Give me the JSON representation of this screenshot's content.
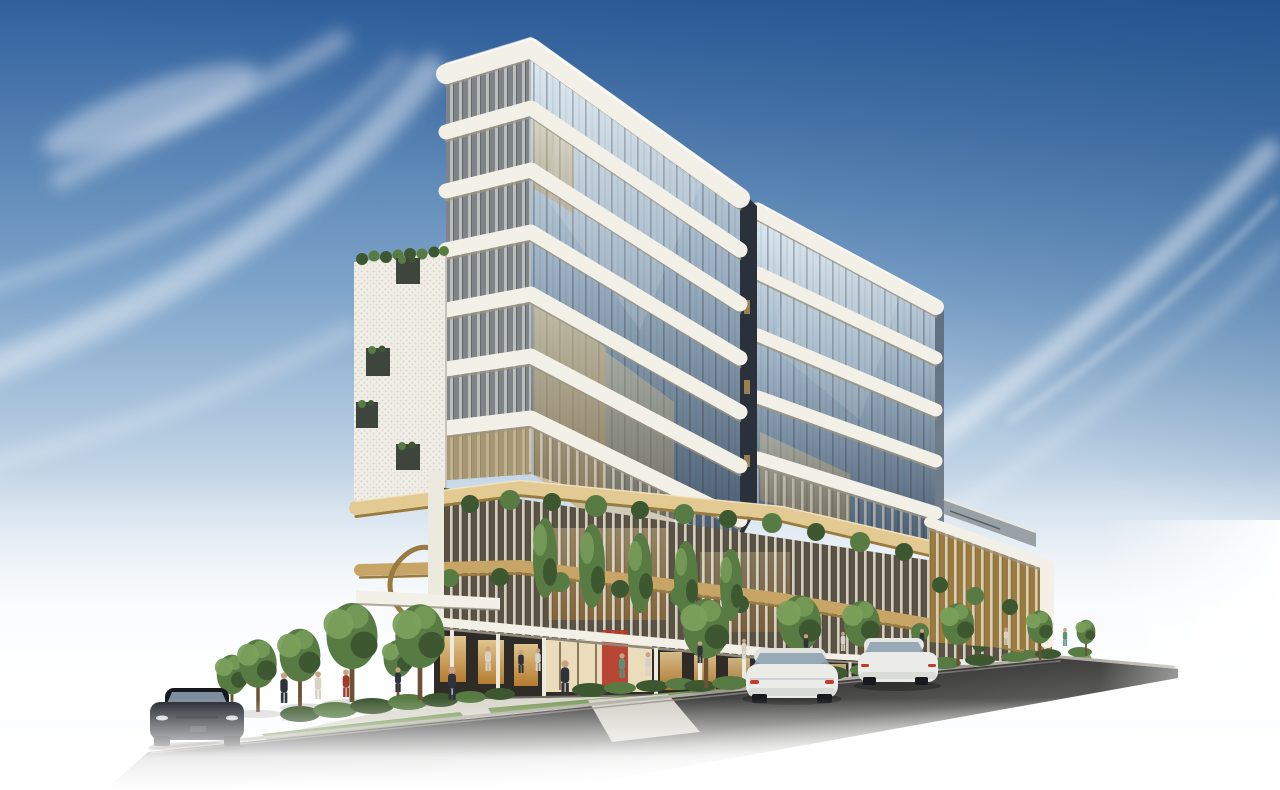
{
  "scene": {
    "type": "architectural-rendering",
    "description": "Daytime photorealistic render of a modern curved mixed-use tower: stacked white rounded floor slabs over glass, a white perforated-screen wing on the left, a golden podium with vertical fins and hanging greenery, ground-floor retail with warm lighting, street trees, pedestrians and three parked cars on a road that fades to white at the image edges under a blue sky with wispy cirrus clouds.",
    "time_of_day": "day",
    "sky": {
      "condition": "clear blue with wispy cirrus cloud streaks",
      "deepest_corner": "top-right",
      "horizon": "fades to white"
    },
    "building": {
      "tower_glass_floors": 7,
      "right_section_floors": 5,
      "podium_levels": 2,
      "features": [
        "rounded white slab bands",
        "glass curtain wall",
        "perforated white screen wing",
        "gold vertical fins with climbing plants",
        "gold feature stair",
        "retail storefronts with warm glow",
        "red art panel",
        "white canopy colonnade",
        "roof-deck pavilion on right wing"
      ]
    },
    "vehicles": [
      {
        "kind": "dark sedan, front view",
        "color_key": "car_dark"
      },
      {
        "kind": "white coupe, rear view",
        "color_key": "car_white"
      },
      {
        "kind": "white sedan, rear view",
        "color_key": "car_white"
      }
    ],
    "trees_count": 11,
    "pedestrians_count": 17
  },
  "colors": {
    "sky_top": "#30609d",
    "sky_mid": "#7da3c9",
    "sky_low": "#c2d5e6",
    "sky_pale": "#e9f0f6",
    "sky_deep": "#16477f",
    "white": "#ffffff",
    "band": "#f3f0e8",
    "band_shadow": "#9c9483",
    "glass_light": "#e4eef5",
    "glass_mid": "#9db2c4",
    "glass_dark": "#47596d",
    "mullion": "#2f3944",
    "glass_warm": "#eed69a",
    "glass_amber": "#b9873a",
    "screen_bg": "#4a524d",
    "screen_light": "#ced1d0",
    "screen_mid": "#878d92",
    "screen_dark": "#5a6167",
    "perf_white": "#f0ede6",
    "perf_dot": "#d2cdc3",
    "opening": "#3e453c",
    "gold": "#c7a566",
    "gold_light": "#e3ca92",
    "gold_dark": "#997b3f",
    "leaf": "#587b44",
    "leaf_dark": "#3d5830",
    "leaf_light": "#7aa05b",
    "trunk": "#6a5335",
    "store_hi": "#ffe0a0",
    "store_lo": "#cd8a31",
    "store_bg": "#2f2b26",
    "lobby": "#f6e7c4",
    "art_red": "#b23a28",
    "road": "#3f3f3f",
    "sidewalk": "#dad7cd",
    "curb": "#b3afa6",
    "grass": "#7d9c5b",
    "grass_dark": "#5e7c45",
    "roof_gray": "#99a0a6",
    "notch": "#2a313b",
    "edge_return": "#5a6470",
    "car_dark": "#23272e",
    "car_roof": "#15181d",
    "car_glass": "#8fa2b2",
    "car_white": "#ebebe8",
    "tail_red": "#c03b30",
    "skin": "#c9a183",
    "ped_dark": "#2e333b",
    "ped_light": "#d8d2c6",
    "ped_red": "#a33a2d",
    "ped_teal": "#5d8f7a"
  }
}
